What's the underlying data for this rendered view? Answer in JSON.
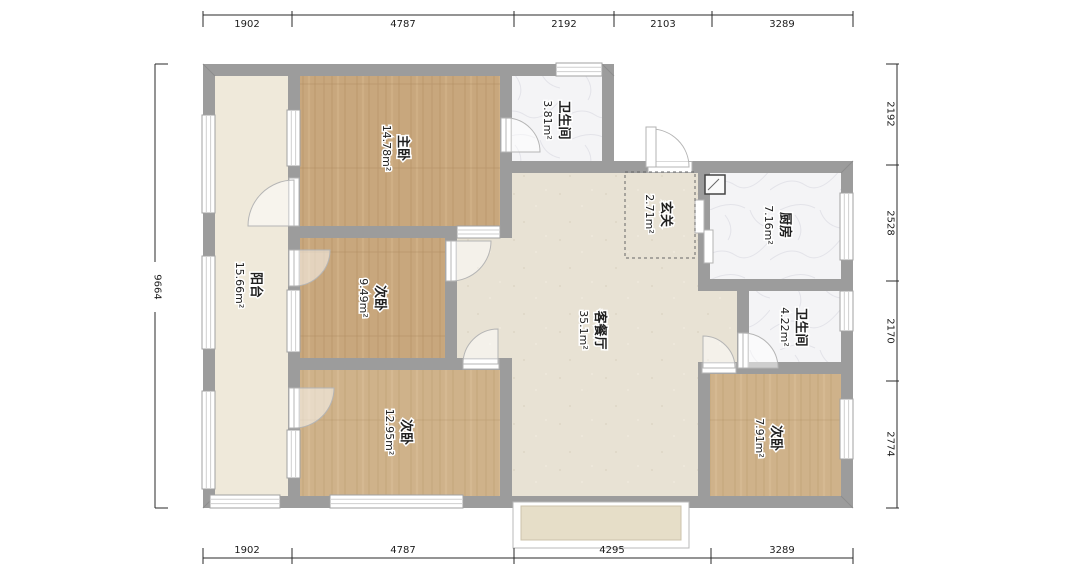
{
  "plan_title": "三室两卫户型平面图",
  "rooms": [
    {
      "id": "balcony",
      "name": "阳台",
      "area": "15.66m²"
    },
    {
      "id": "master-bedroom",
      "name": "主卧",
      "area": "14.78m²"
    },
    {
      "id": "bathroom-top",
      "name": "卫生间",
      "area": "3.81m²"
    },
    {
      "id": "entry",
      "name": "玄关",
      "area": "2.71m²"
    },
    {
      "id": "kitchen",
      "name": "厨房",
      "area": "7.16m²"
    },
    {
      "id": "bedroom-middle",
      "name": "次卧",
      "area": "9.49m²"
    },
    {
      "id": "living-dining",
      "name": "客餐厅",
      "area": "35.1m²"
    },
    {
      "id": "bathroom-right",
      "name": "卫生间",
      "area": "4.22m²"
    },
    {
      "id": "bedroom-bottom-left",
      "name": "次卧",
      "area": "12.95m²"
    },
    {
      "id": "bedroom-bottom-right",
      "name": "次卧",
      "area": "7.91m²"
    }
  ],
  "dimensions": {
    "top": [
      "1902",
      "4787",
      "2192",
      "2103",
      "3289"
    ],
    "bottom": [
      "1902",
      "4787",
      "4295",
      "3289"
    ],
    "left": [
      "9664"
    ],
    "right": [
      "2192",
      "2528",
      "2170",
      "2774"
    ]
  },
  "colors": {
    "wall": "#9c9c9c",
    "wood_floor_dark": "#c8a77d",
    "wood_floor_light": "#cfb28a",
    "living_floor": "#e8e2d4",
    "balcony_floor": "#efe9da",
    "tile_floor": "#f4f4f6",
    "bay_sill": "#e6dec8",
    "dim_text": "#1c1c1c"
  }
}
